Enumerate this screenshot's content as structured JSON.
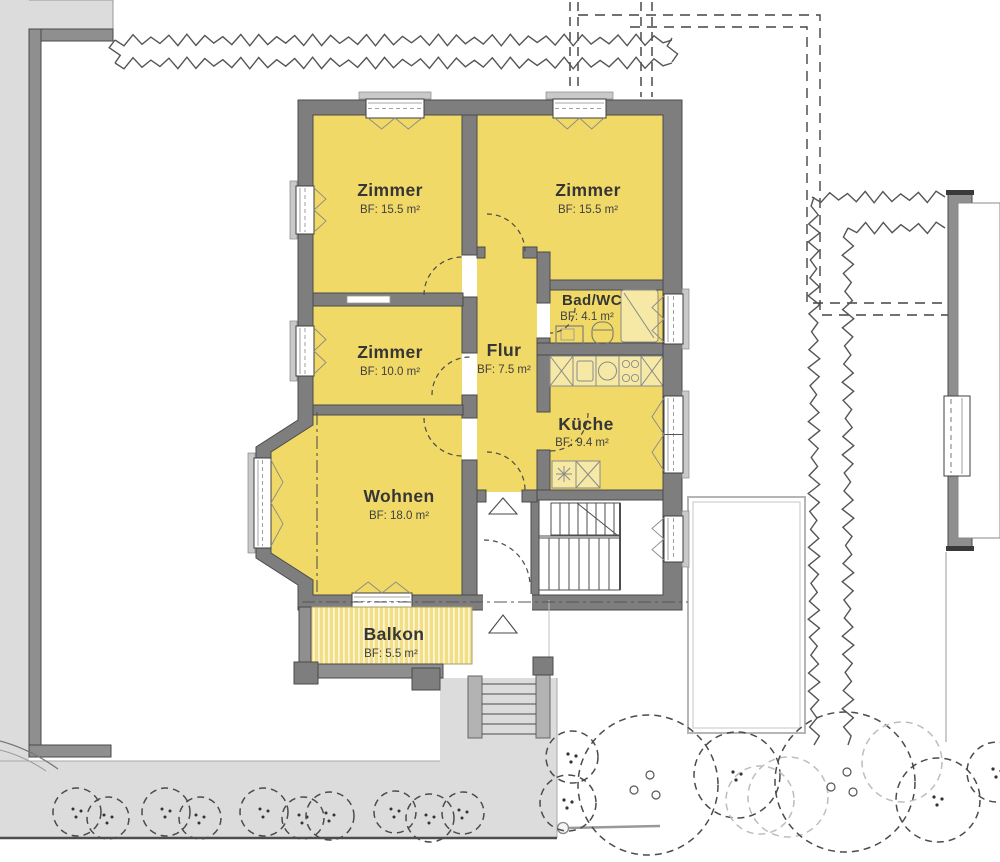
{
  "plan": {
    "type": "apartment-floor-plan",
    "rooms": null
  },
  "rooms": [
    {
      "id": "zimmer-top-left",
      "name": "Zimmer",
      "area": "BF: 15.5 m²"
    },
    {
      "id": "zimmer-top-right",
      "name": "Zimmer",
      "area": "BF: 15.5 m²"
    },
    {
      "id": "bad-wc",
      "name": "Bad/WC",
      "area": "BF: 4.1 m²"
    },
    {
      "id": "zimmer-mid-left",
      "name": "Zimmer",
      "area": "BF: 10.0 m²"
    },
    {
      "id": "flur",
      "name": "Flur",
      "area": "BF: 7.5 m²"
    },
    {
      "id": "kueche",
      "name": "Küche",
      "area": "BF: 9.4 m²"
    },
    {
      "id": "wohnen",
      "name": "Wohnen",
      "area": "BF: 18.0 m²"
    },
    {
      "id": "balkon",
      "name": "Balkon",
      "area": "BF: 5.5 m²"
    }
  ],
  "colors": {
    "room_fill": "#F0D967",
    "room_fill_light": "#F5E9A5",
    "wall": "#7E7E7E",
    "wall_dark": "#4A4A4A",
    "paving": "#DCDCDC",
    "line": "#4D4D4D",
    "text": "#363636",
    "background": "#FFFFFF"
  }
}
